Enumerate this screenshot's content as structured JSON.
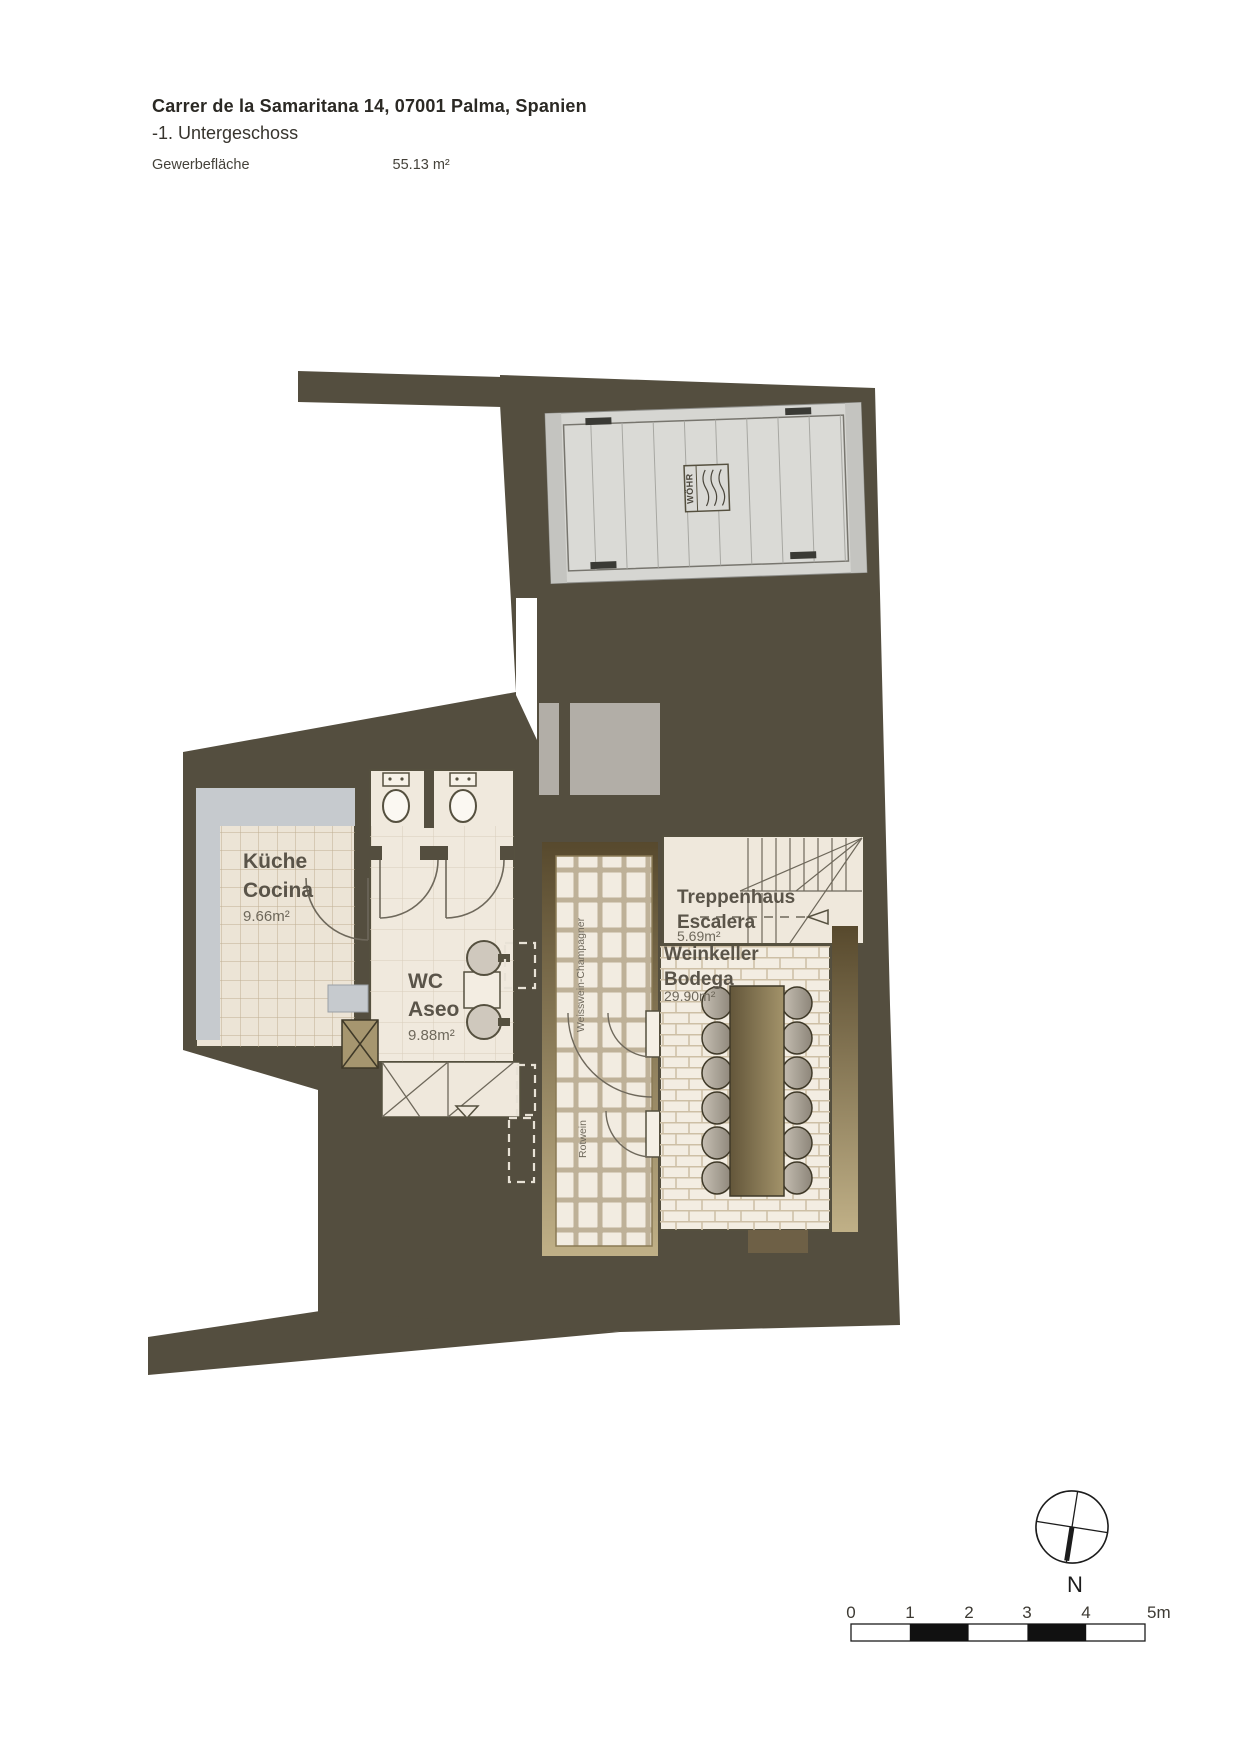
{
  "header": {
    "title": "Carrer de la Samaritana 14, 07001 Palma, Spanien",
    "floor": "-1. Untergeschoss",
    "area_label": "Gewerbefläche",
    "area_value": "55.13 m²"
  },
  "rooms": {
    "kitchen": {
      "name_de": "Küche",
      "name_es": "Cocina",
      "area": "9.66m²"
    },
    "wc": {
      "name_de": "WC",
      "name_es": "Aseo",
      "area": "9.88m²"
    },
    "stairs": {
      "name_de": "Treppenhaus",
      "name_es": "Escalera",
      "area": "5.69m²"
    },
    "wine_cellar": {
      "name_de": "Weinkeller",
      "name_es": "Bodega",
      "area": "29.90m²"
    }
  },
  "wine_racks": {
    "white_wine": "Weisswein-Champagner",
    "red_wine": "Rotwein"
  },
  "car_lift": {
    "brand": "WÖHR"
  },
  "compass": {
    "north_label": "N"
  },
  "scale_bar": {
    "ticks": [
      "0",
      "1",
      "2",
      "3",
      "4",
      "5m"
    ]
  },
  "colors": {
    "wall": "#544E3F",
    "floor": "#EFE8DC",
    "tan": "#8A7A55",
    "silver": "#C6CACE",
    "platform": "#D6D6D2"
  }
}
